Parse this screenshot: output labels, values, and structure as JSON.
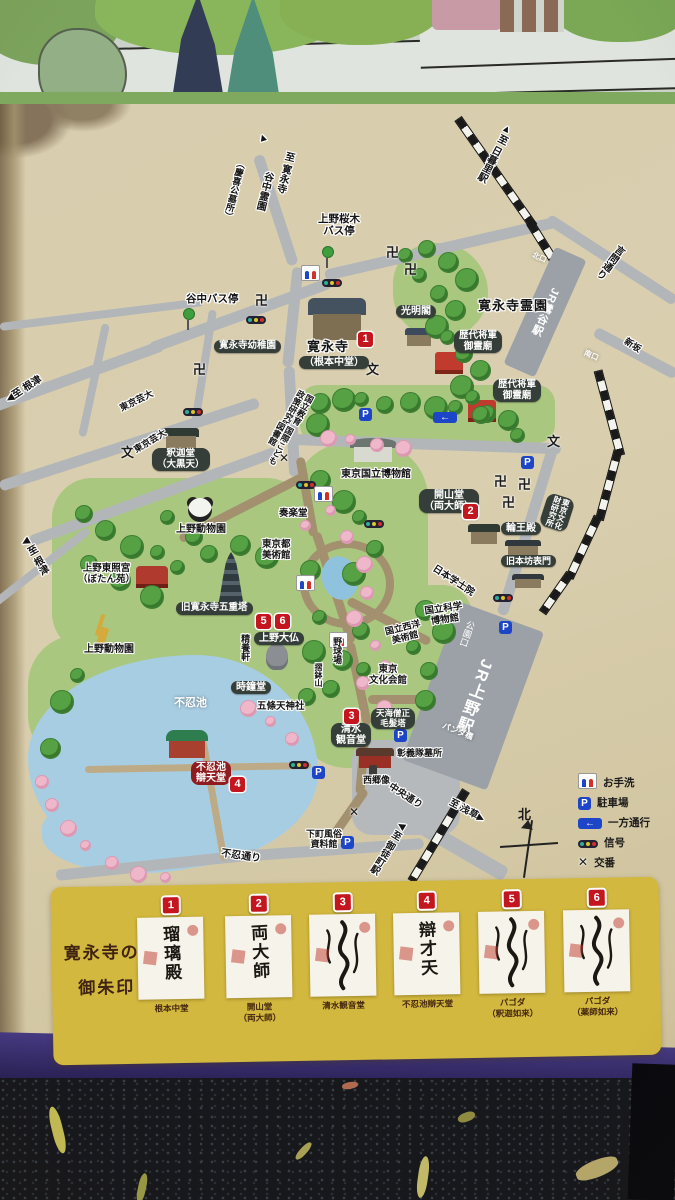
{
  "map": {
    "labels": [
      {
        "t": "▲",
        "x": 256,
        "y": 134,
        "fs": 11,
        "rot": -18
      },
      {
        "t": "至 寛永寺",
        "x": 284,
        "y": 150,
        "v": 1,
        "rot": 14,
        "fs": 10
      },
      {
        "t": "谷中霊園",
        "x": 263,
        "y": 170,
        "v": 1,
        "rot": 14,
        "fs": 10
      },
      {
        "t": "（慶喜公墓所）",
        "x": 237,
        "y": 158,
        "v": 1,
        "rot": 14,
        "fs": 9
      },
      {
        "t": "上野桜木\nバス停",
        "x": 318,
        "y": 214,
        "fs": 10.5,
        "ta": "center"
      },
      {
        "t": "谷中バス停",
        "x": 186,
        "y": 294,
        "fs": 10.5
      },
      {
        "t": "▲至 日暮里駅",
        "x": 504,
        "y": 122,
        "v": 1,
        "rot": 28,
        "fs": 10
      },
      {
        "t": "言問通り",
        "x": 617,
        "y": 242,
        "v": 1,
        "rot": 37,
        "fs": 10
      },
      {
        "t": "新坂",
        "x": 628,
        "y": 336,
        "rot": 33,
        "fs": 9
      },
      {
        "t": "◀至 根津",
        "x": 4,
        "y": 396,
        "rot": -33,
        "fs": 10
      },
      {
        "t": "東京芸大",
        "x": 118,
        "y": 404,
        "rot": -26,
        "fs": 9
      },
      {
        "t": "東京芸大",
        "x": 132,
        "y": 446,
        "rot": -31,
        "fs": 9
      },
      {
        "t": "◀至 根津",
        "x": 18,
        "y": 540,
        "v": 1,
        "rot": -30,
        "fs": 10
      },
      {
        "t": "日本学士院",
        "x": 436,
        "y": 564,
        "rot": 33,
        "fs": 9.5
      },
      {
        "t": "中央通り",
        "x": 392,
        "y": 782,
        "rot": 33,
        "fs": 9.5
      },
      {
        "t": "至 浅草▶",
        "x": 452,
        "y": 798,
        "rot": 28,
        "fs": 9.5
      },
      {
        "t": "◀至 御徒町駅",
        "x": 399,
        "y": 818,
        "v": 1,
        "rot": 32,
        "fs": 9.5
      },
      {
        "t": "不忍通り",
        "x": 222,
        "y": 848,
        "rot": 8,
        "fs": 10
      },
      {
        "t": "パンダ橋",
        "x": 444,
        "y": 722,
        "rot": 22,
        "fs": 8,
        "cls": "w"
      },
      {
        "t": "寛永寺幼稚園",
        "x": 214,
        "y": 340,
        "cls": "b",
        "fs": 9.5
      },
      {
        "t": "光明閣",
        "x": 396,
        "y": 305,
        "cls": "b",
        "fs": 10
      },
      {
        "t": "寛永寺霊園",
        "x": 478,
        "y": 299,
        "cls": "hb"
      },
      {
        "t": "歴代将軍\n御霊廟",
        "x": 454,
        "y": 330,
        "cls": "b",
        "fs": 9.5,
        "ta": "center"
      },
      {
        "t": "歴代将軍\n御霊廟",
        "x": 493,
        "y": 379,
        "cls": "b",
        "fs": 9.5,
        "ta": "center"
      },
      {
        "t": "釈迦堂\n（大黒天）",
        "x": 152,
        "y": 448,
        "cls": "b",
        "fs": 9.5,
        "ta": "center"
      },
      {
        "t": "上野動物園",
        "x": 176,
        "y": 524,
        "fs": 10
      },
      {
        "t": "上野東照宮\n（ぼたん苑）",
        "x": 78,
        "y": 564,
        "fs": 9.5,
        "ta": "center"
      },
      {
        "t": "上野動物園",
        "x": 84,
        "y": 644,
        "fs": 10
      },
      {
        "t": "旧寛永寺五重塔",
        "x": 176,
        "y": 602,
        "cls": "b",
        "fs": 9.5
      },
      {
        "t": "上野大仏",
        "x": 254,
        "y": 632,
        "cls": "b",
        "fs": 10
      },
      {
        "t": "精養軒",
        "x": 240,
        "y": 634,
        "v": 1,
        "fs": 9
      },
      {
        "t": "時鐘堂",
        "x": 231,
        "y": 681,
        "cls": "b",
        "fs": 10
      },
      {
        "t": "五條天神社",
        "x": 257,
        "y": 702,
        "fs": 9.5
      },
      {
        "t": "不忍池",
        "x": 174,
        "y": 697,
        "cls": "w",
        "fs": 11
      },
      {
        "t": "不忍池\n辯天堂",
        "x": 191,
        "y": 761,
        "cls": "rb",
        "fs": 10,
        "ta": "center"
      },
      {
        "t": "清水\n観音堂",
        "x": 331,
        "y": 723,
        "cls": "b",
        "fs": 10,
        "ta": "center"
      },
      {
        "t": "天海僧正\n毛髪塔",
        "x": 371,
        "y": 708,
        "cls": "b",
        "fs": 8.5,
        "ta": "center"
      },
      {
        "t": "彰義隊墓所",
        "x": 397,
        "y": 748,
        "fs": 9
      },
      {
        "t": "西郷像",
        "x": 363,
        "y": 775,
        "fs": 9
      },
      {
        "t": "下町風俗\n資料館",
        "x": 306,
        "y": 829,
        "fs": 9,
        "ta": "center"
      },
      {
        "t": "奏楽堂",
        "x": 279,
        "y": 509,
        "fs": 9.5
      },
      {
        "t": "東京都\n美術館",
        "x": 262,
        "y": 540,
        "fs": 9.5,
        "ta": "center"
      },
      {
        "t": "東京国立博物館",
        "x": 341,
        "y": 469,
        "fs": 10
      },
      {
        "t": "国立教育\n政策研究所",
        "x": 298,
        "y": 388,
        "v": 1,
        "rot": 28,
        "fs": 8.5
      },
      {
        "t": "国際こども\n図書館",
        "x": 278,
        "y": 420,
        "v": 1,
        "rot": 28,
        "fs": 8.5
      },
      {
        "t": "開山堂\n（両大師）",
        "x": 419,
        "y": 489,
        "cls": "b",
        "fs": 10,
        "ta": "center"
      },
      {
        "t": "輪王殿",
        "x": 501,
        "y": 522,
        "cls": "b",
        "fs": 10
      },
      {
        "t": "旧本坊表門",
        "x": 501,
        "y": 555,
        "cls": "b",
        "fs": 9
      },
      {
        "t": "東京文化\n財研究所",
        "x": 549,
        "y": 492,
        "cls": "b",
        "v": 1,
        "rot": 18,
        "fs": 8
      },
      {
        "t": "国立科学\n博物館",
        "x": 424,
        "y": 607,
        "fs": 9.5,
        "rot": -8,
        "ta": "center"
      },
      {
        "t": "国立西洋\n美術館",
        "x": 384,
        "y": 627,
        "fs": 9,
        "rot": -14,
        "ta": "center"
      },
      {
        "t": "東京\n文化会館",
        "x": 369,
        "y": 665,
        "fs": 9.5,
        "ta": "center"
      },
      {
        "t": "野球場",
        "x": 332,
        "y": 637,
        "v": 1,
        "fs": 9
      },
      {
        "t": "摺鉢山",
        "x": 313,
        "y": 663,
        "v": 1,
        "fs": 8
      },
      {
        "t": "寛永寺",
        "x": 307,
        "y": 340,
        "cls": "hb"
      },
      {
        "t": "（根本中堂）",
        "x": 299,
        "y": 356,
        "cls": "b",
        "fs": 10
      },
      {
        "t": "北口",
        "x": 534,
        "y": 251,
        "cls": "w",
        "fs": 7.5,
        "rot": 24
      },
      {
        "t": "南口",
        "x": 586,
        "y": 349,
        "cls": "w",
        "fs": 7.5,
        "rot": 24
      }
    ],
    "numbered_spots": [
      {
        "n": "1",
        "x": 358,
        "y": 332
      },
      {
        "n": "2",
        "x": 463,
        "y": 504
      },
      {
        "n": "3",
        "x": 344,
        "y": 709
      },
      {
        "n": "4",
        "x": 230,
        "y": 777
      },
      {
        "n": "5",
        "x": 256,
        "y": 614
      },
      {
        "n": "6",
        "x": 275,
        "y": 614
      }
    ],
    "icon_glyphs": {
      "manji": "卍",
      "school": "文",
      "koban": "✕",
      "parking": "P",
      "oneway": "←"
    },
    "icons": [
      {
        "type": "manji",
        "x": 386,
        "y": 242
      },
      {
        "type": "manji",
        "x": 404,
        "y": 259
      },
      {
        "type": "manji",
        "x": 255,
        "y": 290
      },
      {
        "type": "manji",
        "x": 193,
        "y": 359
      },
      {
        "type": "manji",
        "x": 494,
        "y": 471
      },
      {
        "type": "manji",
        "x": 518,
        "y": 474
      },
      {
        "type": "manji",
        "x": 502,
        "y": 492
      },
      {
        "type": "school",
        "x": 366,
        "y": 359
      },
      {
        "type": "school",
        "x": 547,
        "y": 431
      },
      {
        "type": "school",
        "x": 121,
        "y": 442
      },
      {
        "type": "koban",
        "x": 279,
        "y": 449
      },
      {
        "type": "koban",
        "x": 349,
        "y": 803
      },
      {
        "type": "signal",
        "x": 322,
        "y": 272
      },
      {
        "type": "signal",
        "x": 246,
        "y": 309
      },
      {
        "type": "signal",
        "x": 183,
        "y": 401
      },
      {
        "type": "signal",
        "x": 296,
        "y": 474
      },
      {
        "type": "signal",
        "x": 364,
        "y": 513
      },
      {
        "type": "signal",
        "x": 493,
        "y": 587
      },
      {
        "type": "signal",
        "x": 289,
        "y": 754
      },
      {
        "type": "toilet",
        "x": 301,
        "y": 265
      },
      {
        "type": "toilet",
        "x": 314,
        "y": 486
      },
      {
        "type": "toilet",
        "x": 296,
        "y": 575
      },
      {
        "type": "toilet",
        "x": 329,
        "y": 632
      },
      {
        "type": "parking",
        "x": 359,
        "y": 404
      },
      {
        "type": "parking",
        "x": 521,
        "y": 452
      },
      {
        "type": "parking",
        "x": 499,
        "y": 617
      },
      {
        "type": "parking",
        "x": 394,
        "y": 725
      },
      {
        "type": "parking",
        "x": 312,
        "y": 762
      },
      {
        "type": "parking",
        "x": 341,
        "y": 832
      },
      {
        "type": "oneway",
        "x": 433,
        "y": 407
      },
      {
        "type": "busstop",
        "x": 322,
        "y": 246
      },
      {
        "type": "busstop",
        "x": 183,
        "y": 308
      }
    ],
    "stations": {
      "uguisudani": {
        "line_prefix": "JR",
        "name": "JR鶯谷駅"
      },
      "ueno": {
        "gate": "公園口",
        "name": "JR上野駅"
      }
    },
    "legend": {
      "items": [
        {
          "icon": "toilet",
          "label": "お手洗"
        },
        {
          "icon": "parking",
          "label": "駐車場"
        },
        {
          "icon": "oneway",
          "label": "一方通行"
        },
        {
          "icon": "signal",
          "label": "信号"
        },
        {
          "icon": "koban",
          "label": "交番"
        }
      ]
    },
    "compass_north": "北"
  },
  "goshuin_panel": {
    "title_line1": "寛永寺の",
    "title_line2": "御朱印",
    "items": [
      {
        "num": "1",
        "ink": "瑠璃殿",
        "label": "根本中堂"
      },
      {
        "num": "2",
        "ink": "両大師",
        "label": "開山堂\n（両大師）"
      },
      {
        "num": "3",
        "ink": "",
        "label": "清水観音堂"
      },
      {
        "num": "4",
        "ink": "辯才天",
        "label": "不忍池辯天堂"
      },
      {
        "num": "5",
        "ink": "",
        "label": "パゴダ\n（釈迦如来）"
      },
      {
        "num": "6",
        "ink": "",
        "label": "パゴダ\n（薬師如来）"
      }
    ]
  }
}
